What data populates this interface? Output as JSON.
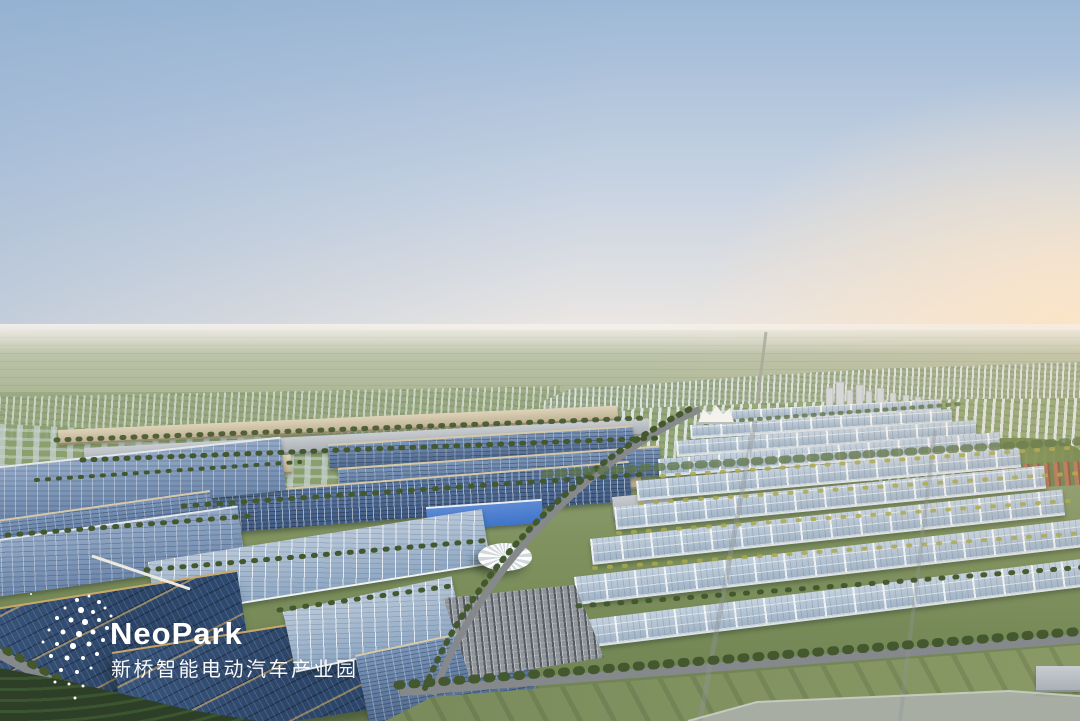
{
  "watermark": {
    "brand": "NeoPark",
    "subtitle": "新桥智能电动汽车产业园"
  },
  "palette": {
    "sky_top": "#9db8d6",
    "sky_mid": "#c6d2e2",
    "sky_horizon": "#efe9e3",
    "sun_glow": "#fbe7cd",
    "plain_far": "#c6cab6",
    "plain_near": "#a9b591",
    "city_light": "#e2e6e4",
    "ground_green": "#7f925f",
    "lawn": "#7a8c5c",
    "tree_green": "#44582f",
    "tree_yellow": "#a8a84e",
    "road_gray": "#85898b",
    "solar_dark": "#2c4568",
    "solar_mid": "#50698e",
    "solar_light": "#8ea7c2",
    "warehouse_roof": "#b7c7d6",
    "tan_roof": "#d6c9aa",
    "gold_trim": "#c9a96b",
    "facade_blue": "#3f74c9",
    "water_gray": "#a8ada3",
    "logo_white": "#ffffff"
  }
}
